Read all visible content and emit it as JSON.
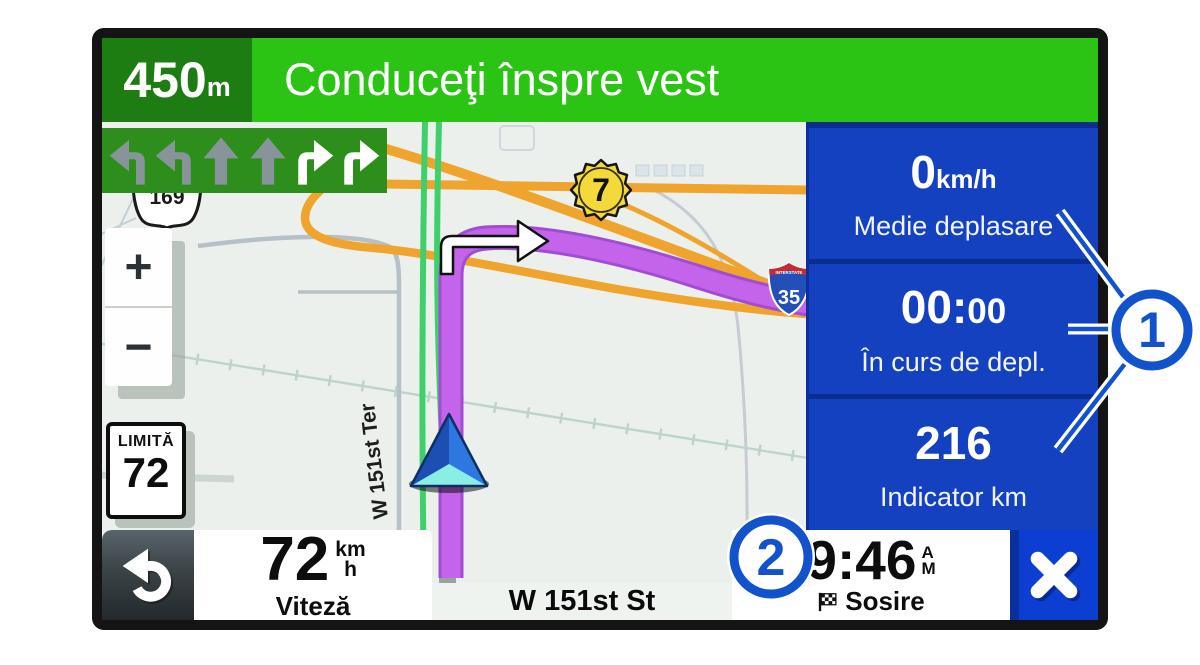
{
  "top_bar": {
    "distance_value": "450",
    "distance_unit": "m",
    "instruction": "Conduceţi înspre vest"
  },
  "lane_guidance": {
    "arrows": [
      "turn-left",
      "turn-left",
      "straight",
      "straight",
      "turn-right",
      "turn-right"
    ]
  },
  "map": {
    "zoom_in_label": "+",
    "zoom_out_label": "−",
    "speed_limit": {
      "label": "LIMITĂ",
      "value": "72"
    },
    "shields": {
      "state_route": "7",
      "us_route": "169",
      "interstate": "35",
      "interstate_banner": "INTERSTATE"
    },
    "road_labels": {
      "ter": "W 151st Ter"
    }
  },
  "sidebar": {
    "fields": [
      {
        "value": "0",
        "unit": "km/h",
        "label": "Medie deplasare"
      },
      {
        "value": "00:",
        "value_minor": "00",
        "label": "În curs de depl."
      },
      {
        "value": "216",
        "label": "Indicator km"
      }
    ]
  },
  "bottom_bar": {
    "speed": {
      "value": "72",
      "unit_top": "km",
      "unit_bottom": "h",
      "label": "Viteză"
    },
    "street_name": "W 151st St",
    "arrival": {
      "time": "9:46",
      "meridiem_top": "A",
      "meridiem_bottom": "M",
      "label": "Sosire"
    }
  },
  "callouts": {
    "one": "1",
    "two": "2"
  },
  "colors": {
    "banner_green_bright": "#2cc414",
    "banner_green_dark": "#1e7d12",
    "sidebar_blue": "#1441c0",
    "route_purple": "#c364ea",
    "callout_blue": "#1253cc"
  }
}
